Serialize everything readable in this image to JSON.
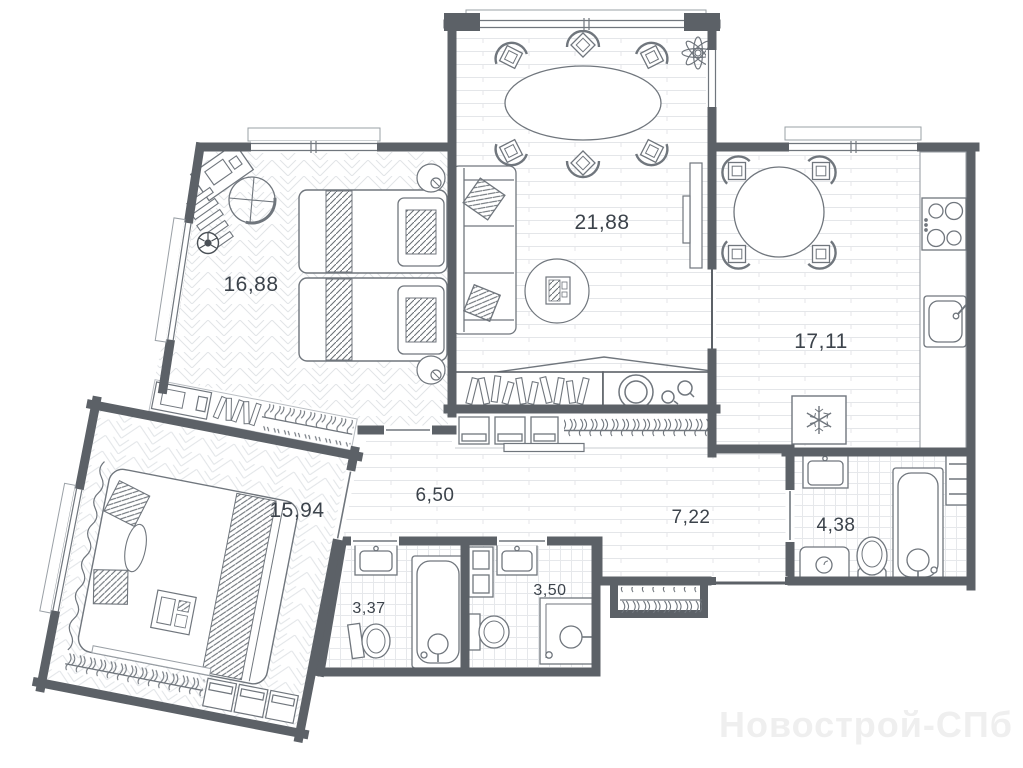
{
  "plan": {
    "title": "apartment-floor-plan",
    "watermark": "Новострой-СПб",
    "rooms": [
      {
        "id": "bedroom-top-left",
        "area": "16,88"
      },
      {
        "id": "living-dining",
        "area": "21,88"
      },
      {
        "id": "kitchen",
        "area": "17,11"
      },
      {
        "id": "bedroom-bottom-left",
        "area": "15,94"
      },
      {
        "id": "hall-left",
        "area": "6,50"
      },
      {
        "id": "hall-right",
        "area": "7,22"
      },
      {
        "id": "bathroom-big",
        "area": "4,38"
      },
      {
        "id": "bathroom-small",
        "area": "3,37"
      },
      {
        "id": "shower-room",
        "area": "3,50"
      }
    ],
    "icons": [
      "double-bed",
      "single-bed",
      "sofa",
      "dining-table",
      "kitchen-table",
      "chair",
      "desk",
      "office-chair",
      "soccer-ball",
      "plant",
      "fridge-snowflake",
      "stove",
      "kitchen-sink",
      "bathtub",
      "shower-cabin",
      "toilet",
      "washbasin",
      "washing-machine",
      "wardrobe-hangers",
      "towel-rail",
      "tv-console",
      "rug"
    ],
    "colors": {
      "wall": "#5c6167",
      "furniture_line": "#70767d",
      "floor_line": "#e2e4e7",
      "label": "#3c434b",
      "watermark": "#efefef",
      "background": "#ffffff"
    }
  }
}
